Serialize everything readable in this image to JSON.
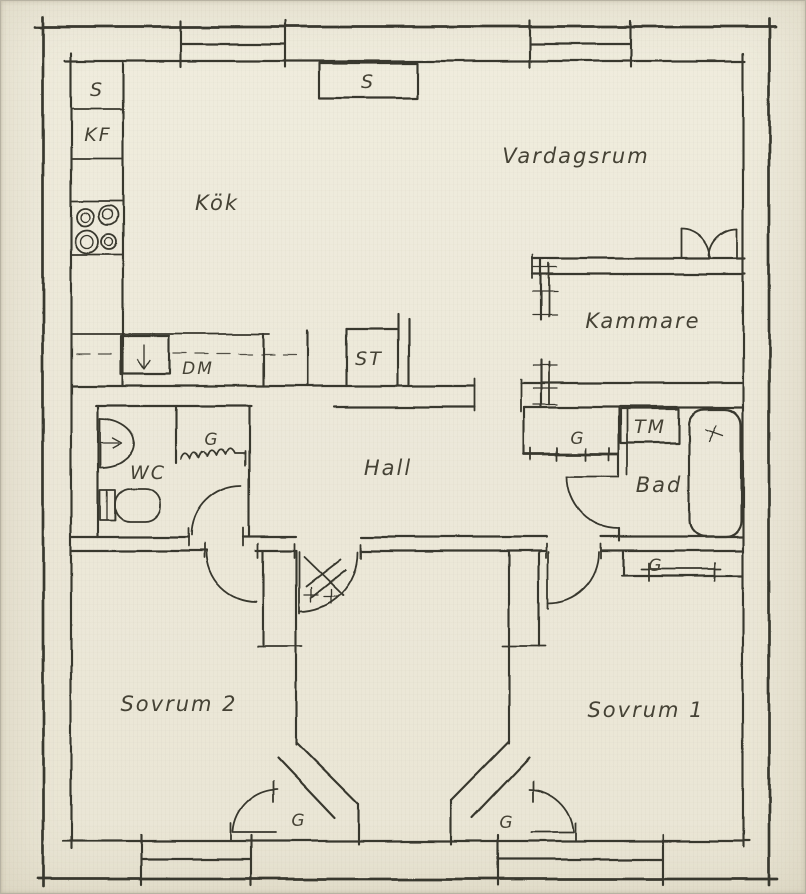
{
  "plan": {
    "type": "floor-plan-sketch",
    "rooms": {
      "kok": "Kök",
      "vardagsrum": "Vardagsrum",
      "kammare": "Kammare",
      "hall": "Hall",
      "wc": "WC",
      "bad": "Bad",
      "sovrum2": "Sovrum 2",
      "sovrum1": "Sovrum 1"
    },
    "fixtures": {
      "s_cabinet": "S",
      "kf_fridge_freezer": "KF",
      "s_sideboard": "S",
      "dm_dishwasher": "DM",
      "st_cleaning_closet": "ST",
      "tm_washing_machine": "TM",
      "g_closet_wc": "G",
      "g_closet_bad": "G",
      "g_closet_sovrum1_top": "G",
      "g_closet_sovrum2": "G",
      "g_closet_sovrum1": "G"
    },
    "colors": {
      "paper": "#ece8da",
      "ink": "#39372e"
    }
  }
}
